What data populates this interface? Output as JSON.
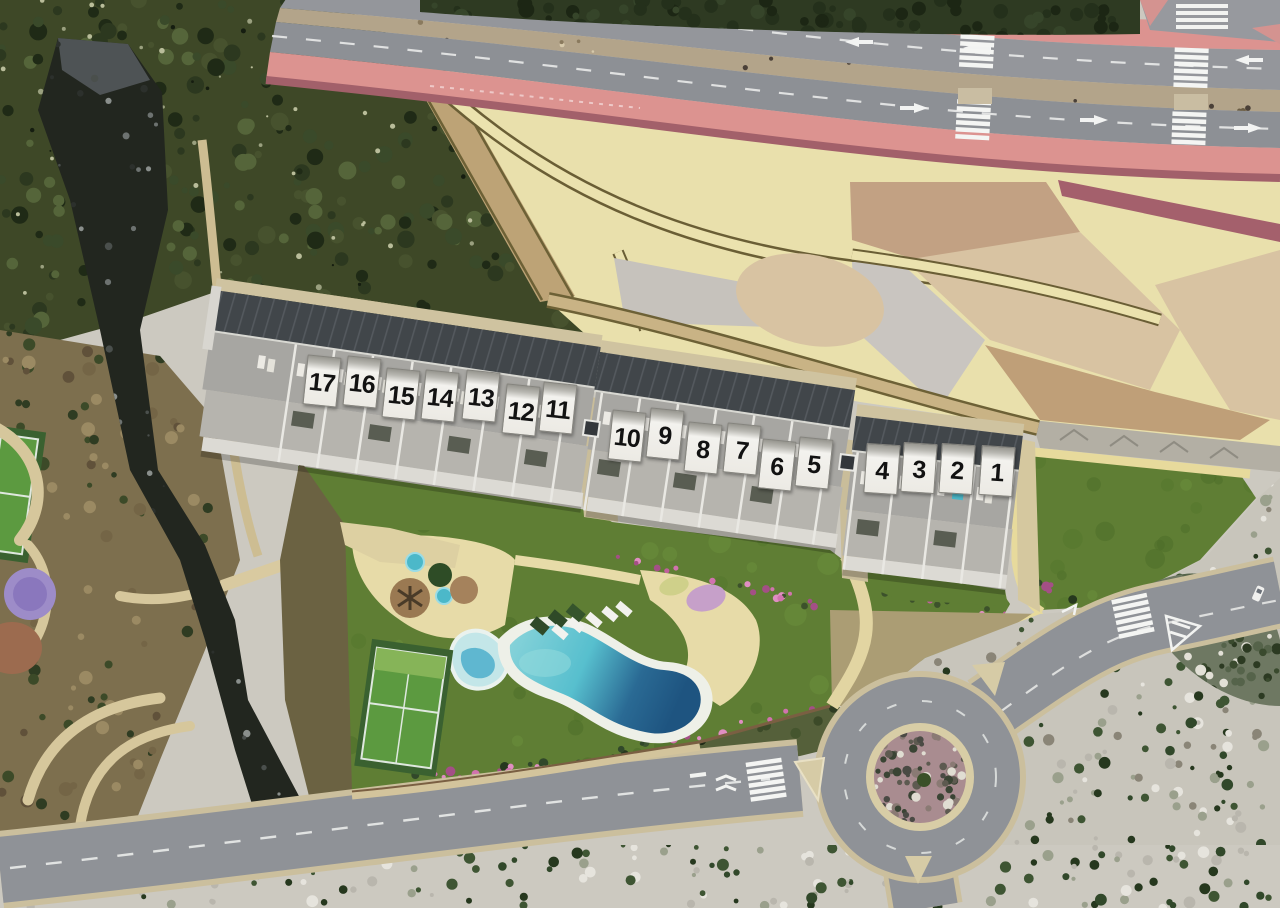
{
  "scene": {
    "description": "Aerial 3D render of a hillside residential development with 17 numbered terraced townhouses, communal pool garden, sports courts, landscaped esplanade, dual-carriageway road and roundabout",
    "view": "top-down aerial render"
  },
  "units": [
    {
      "label": "17"
    },
    {
      "label": "16"
    },
    {
      "label": "15"
    },
    {
      "label": "14"
    },
    {
      "label": "13"
    },
    {
      "label": "12"
    },
    {
      "label": "11"
    },
    {
      "label": "10"
    },
    {
      "label": "9"
    },
    {
      "label": "8"
    },
    {
      "label": "7"
    },
    {
      "label": "6"
    },
    {
      "label": "5"
    },
    {
      "label": "4"
    },
    {
      "label": "3"
    },
    {
      "label": "2"
    },
    {
      "label": "1"
    }
  ],
  "features": {
    "main_pool": "communal swimming pool",
    "kids_pool": "children's pool",
    "jacuzzis": "round plunge tubs",
    "paddle_court": "paddle court",
    "left_court": "sports court",
    "playground": "purple playground circle",
    "sun_loungers": "white sun loungers",
    "roundabout": "roundabout with planted island",
    "main_road": "dual carriageway with median",
    "south_road": "perimeter road",
    "crosswalks": "zebra crossings",
    "ravine": "rocky ravine",
    "scrub_hill": "scrub hillside",
    "esplanade": "landscaped cream esplanade",
    "east_lawn": "communal lawn",
    "flowers": "bougainvillea hedge"
  },
  "colors": {
    "lawn": "#5f7e34",
    "pool_shallow": "#7fd0d8",
    "pool_deep": "#1f5480",
    "pool_deck": "#e7dba8",
    "asphalt": "#8f9297",
    "sidewalk_pink": "#dc9390",
    "esplanade_cream": "#e9e0ac",
    "path_tan": "#bda376",
    "roof_grey": "#41464a",
    "terrace_grey": "#a7a6a2",
    "plate_white": "#f2f1ed",
    "scrub_dark": "#3e4827",
    "scrubland_light": "#ccc9c0",
    "flower_pink": "#c0609c",
    "court_green": "#5c9a40",
    "playground_purple": "#9d8cc8",
    "roundabout_island": "#a98c90"
  }
}
